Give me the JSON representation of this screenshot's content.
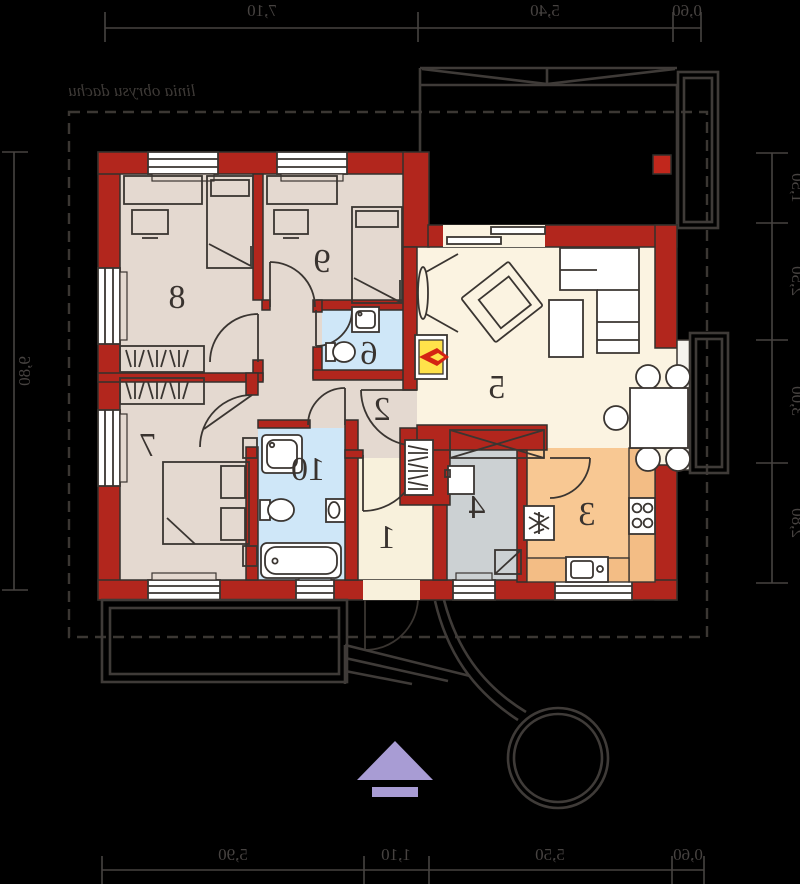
{
  "plan": {
    "roof_outline_label": "linia obrysu dachu",
    "rooms": [
      {
        "number": "1"
      },
      {
        "number": "2"
      },
      {
        "number": "3"
      },
      {
        "number": "4"
      },
      {
        "number": "5"
      },
      {
        "number": "6"
      },
      {
        "number": "7"
      },
      {
        "number": "8"
      },
      {
        "number": "9"
      },
      {
        "number": "10"
      }
    ],
    "dimensions": {
      "top": [
        "7,10",
        "5,40",
        "0,60"
      ],
      "bottom": [
        "5,90",
        "1,10",
        "5,50",
        "0,60"
      ],
      "left": [
        "9,80"
      ],
      "right": [
        "1,50",
        "2,50",
        "3,00",
        "2,80"
      ]
    },
    "colors": {
      "wall": "#b2261d",
      "bedroom_floor": "#e4d9d0",
      "living_floor": "#fbf3e1",
      "bath_floor": "#cfe7f8",
      "kitchen_floor": "#f8c893",
      "utility_floor": "#ccd1d3",
      "fireplace_yellow": "#ffe24a",
      "flame_red": "#d42313",
      "north_arrow_purple": "#a89cd4",
      "line": "#3a3531",
      "background": "#000000"
    }
  }
}
